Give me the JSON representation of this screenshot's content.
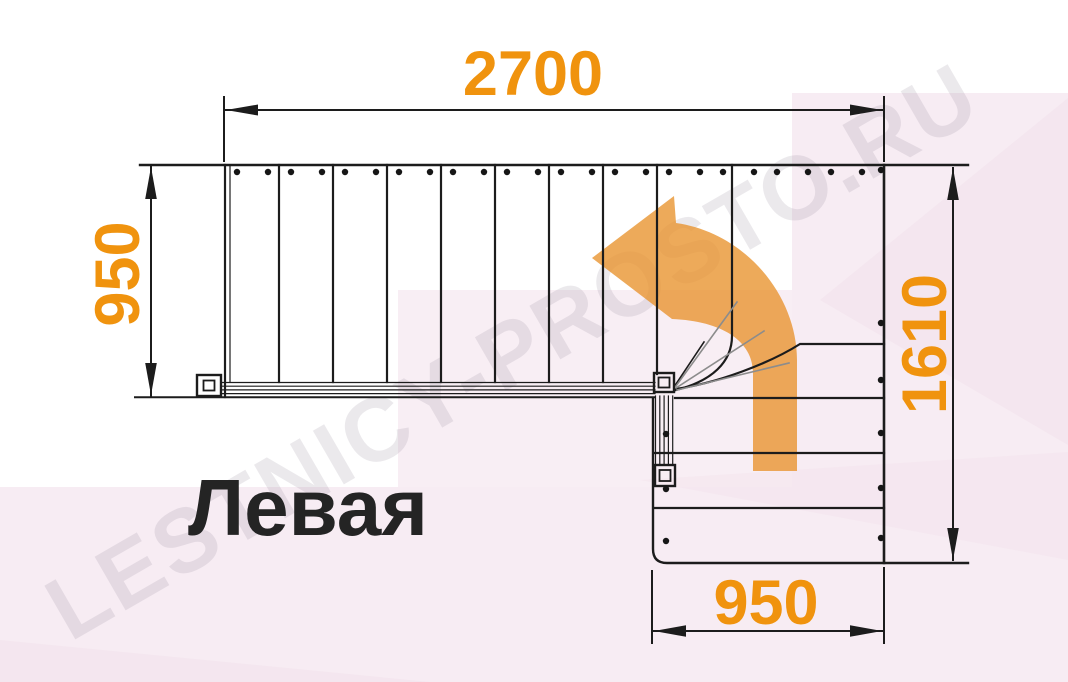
{
  "title": {
    "label": "Левая",
    "color": "#242424"
  },
  "watermark": {
    "label": "LESTNICY-PROSTO.RU"
  },
  "dimensions": {
    "top": {
      "label": "2700"
    },
    "left": {
      "label": "950"
    },
    "right": {
      "label": "1610"
    },
    "bottom": {
      "label": "950"
    }
  },
  "plan": {
    "type": "staircase-floor-plan",
    "upper_flight_treads": 8,
    "lower_flight_treads": 4,
    "winder_treads": 3
  },
  "colors": {
    "accent_orange": "#F0930E",
    "arrow_orange": "#E8922C",
    "line": "#1C1C1C",
    "gray_line": "#8C8C8C",
    "background_pink": "#F7ECF3",
    "background_pink_dark": "#F2E2EB",
    "watermark_gray": "#8D8395"
  }
}
